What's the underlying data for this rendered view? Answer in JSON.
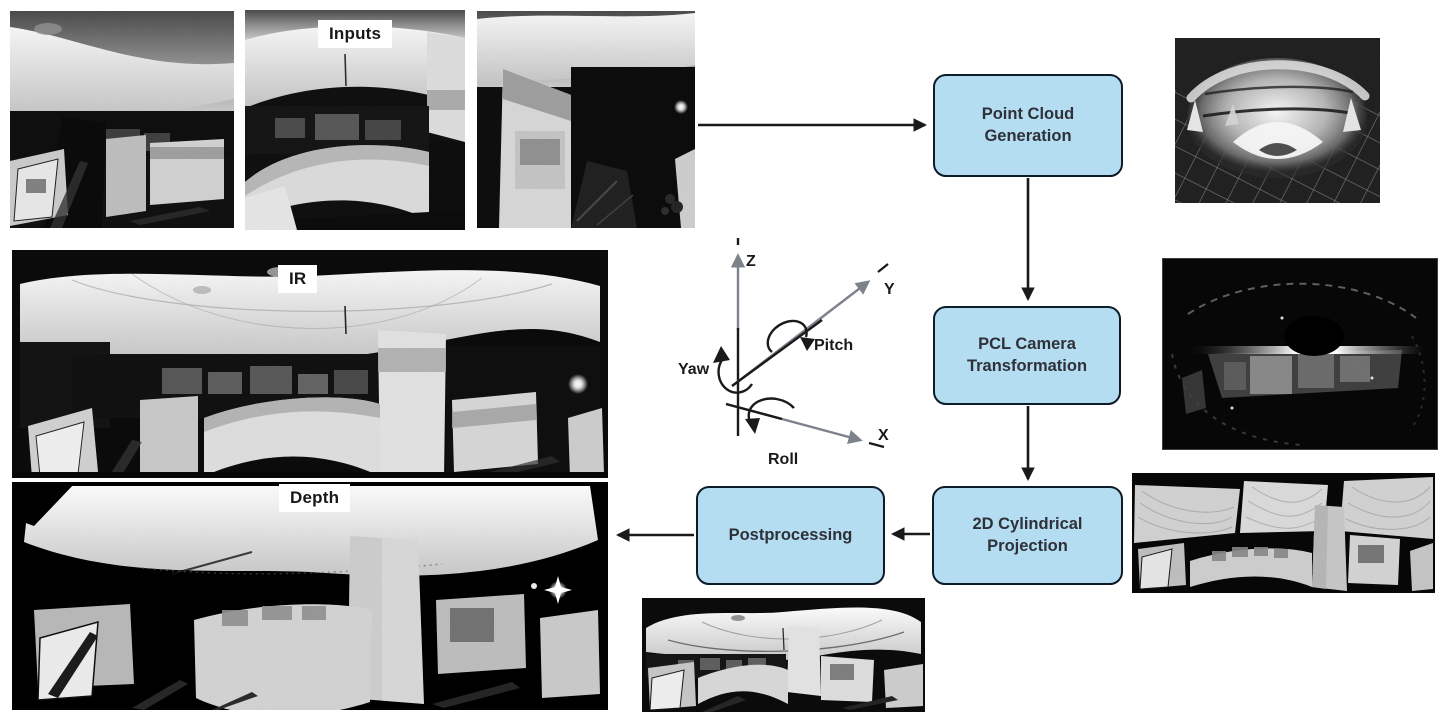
{
  "figure": {
    "type": "processing-pipeline-diagram",
    "background": "#ffffff"
  },
  "labels": {
    "inputs": "Inputs",
    "ir": "IR",
    "depth": "Depth"
  },
  "flowchart": {
    "nodes": [
      {
        "id": "point-cloud-generation",
        "label": "Point Cloud Generation"
      },
      {
        "id": "pcl-camera-transformation",
        "label": "PCL Camera Transformation"
      },
      {
        "id": "cylindrical-projection",
        "label": "2D Cylindrical Projection"
      },
      {
        "id": "postprocessing",
        "label": "Postprocessing"
      }
    ],
    "edges": [
      {
        "from": "input-images",
        "to": "point-cloud-generation"
      },
      {
        "from": "point-cloud-generation",
        "to": "pcl-camera-transformation"
      },
      {
        "from": "pcl-camera-transformation",
        "to": "cylindrical-projection"
      },
      {
        "from": "cylindrical-projection",
        "to": "postprocessing"
      },
      {
        "from": "postprocessing",
        "to": "output-panoramas"
      }
    ],
    "style": {
      "node_fill": "#b5ddf2",
      "node_border": "#0e1b29",
      "node_text": "#2e3138",
      "arrow_color": "#1a1a1a"
    }
  },
  "axes_diagram": {
    "axis_labels": {
      "z": "Z",
      "y": "Y",
      "x": "X"
    },
    "rotation_labels": {
      "yaw": "Yaw",
      "pitch": "Pitch",
      "roll": "Roll"
    },
    "axis_color": "#7d828c",
    "rotation_color": "#1a1a1a"
  },
  "images": {
    "input_photos": [
      "ir-input-photo-1",
      "ir-input-photo-2",
      "ir-input-photo-3"
    ],
    "ir_panorama": "ir-panorama",
    "depth_panorama": "depth-panorama",
    "point_cloud_render": "point-cloud-render",
    "pcl_camera_view": "pcl-camera-view",
    "cylindrical_projection_pano": "cylindrical-projection-pano",
    "postprocessed_pano": "postprocessed-pano"
  }
}
